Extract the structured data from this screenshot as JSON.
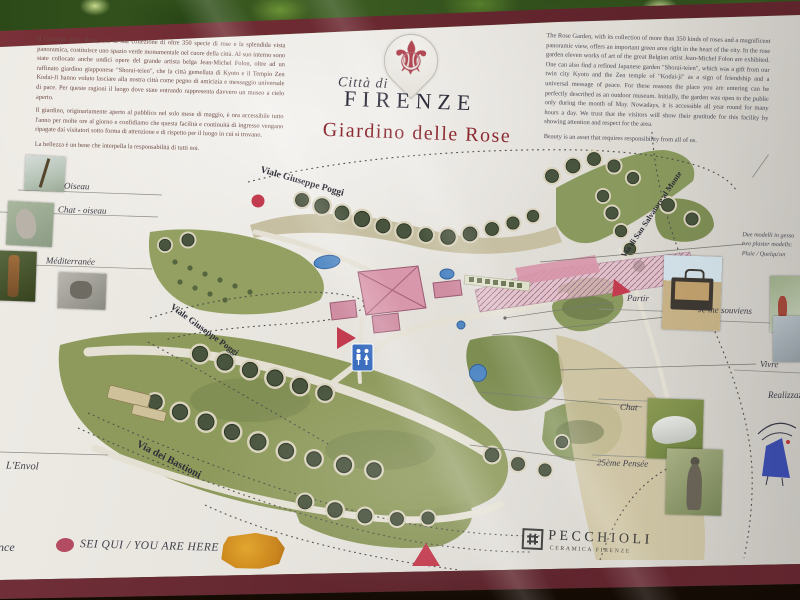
{
  "icons": {
    "fleur_de_lis": "⚜"
  },
  "header": {
    "city_script": "Città di",
    "city_name": "FIRENZE",
    "title": "Giardino delle Rose"
  },
  "intro_it": {
    "p1": "Il Giardino delle Rose, con la sua collezione di oltre 350 specie di rose e la splendida vista panoramica, costituisce uno spazio verde monumentale nel cuore della città. Al suo interno sono state collocate anche undici opere del grande artista belga Jean-Michel Folon, oltre ad un raffinato giardino giapponese \"Shorai-teien\", che la città gemellata di Kyoto e il Tempio Zen Kodai-Ji hanno voluto lasciare alla nostra città come pegno di amicizia e messaggio universale di pace. Per queste ragioni il luogo dove state entrando rappresenta davvero un museo a cielo aperto.",
    "p2": "Il giardino, originariamente aperto al pubblico nel solo mese di maggio, è ora accessibile tutto l'anno per molte ore al giorno e confidiamo che questa facilità e continuità di ingresso vengano ripagate dai visitatori sotto forma di attenzione e di rispetto per il luogo in cui si trovano.",
    "closing": "La bellezza è un bene che interpella la responsabilità di tutti noi."
  },
  "intro_en": {
    "p1": "The Rose Garden, with its collection of more than 350 kinds of roses and a magnificent panoramic view, offers an important green area right in the heart of the city. In the rose garden eleven works of art of the great Belgian artist Jean-Michel Folon are exhibited. One can also find a refined Japanese garden \"Shorai-teien\", which was a gift from our twin city Kyoto and the Zen temple of \"Kodai-ji\" as a sign of friendship and a universal message of peace. For these reasons the place you are entering can be perfectly described as an outdoor museum. Initially, the garden was open to the public only during the month of May. Nowadays, it is accessible all year round for many hours a day. We trust that the visitors will show their gratitude for this facility by showing attention and respect for the area.",
    "closing": "Beauty is an asset that requires responsibility from all of us."
  },
  "artworks_left": {
    "oiseau": "Oiseau",
    "chat_oiseau": "Chat - oiseau",
    "mediterranee": "Méditerranée",
    "envol": "L'Envol",
    "partial_bottom": "nce"
  },
  "artworks_right": {
    "plaster_note_line1": "Due modelli in gesso",
    "plaster_note_line2": "two plaster modells:",
    "plaster_note_line3": "Pluie / Quelqu'un",
    "partir": "Partir",
    "je_me_souviens": "Je me souviens",
    "vivre": "Vivre",
    "realizzaz_partial": "Realizzaz",
    "chat": "Chat",
    "pensee": "25ème Pensée"
  },
  "map": {
    "roads": {
      "viale_poggi_top": "Viale Giuseppe Poggi",
      "viale_poggi_mid": "Viale Giuseppe Poggi",
      "via_bastioni": "Via dei Bastioni",
      "via_san_salvatore": "Via di San Salvatore al Monte"
    }
  },
  "footer": {
    "you_are_here": "SEI QUI / YOU ARE HERE",
    "brand": "PECCHIOLI",
    "brand_sub": "CERAMICA FIRENZE"
  },
  "colors": {
    "frame_maroon": "#6b2a32",
    "title_red": "#8c2a32",
    "logo_red": "#b24854",
    "marker_red": "#c23b4e",
    "lawn_green": "#8e9a5c",
    "pond_blue": "#5188c4",
    "wc_blue": "#3d6fc0",
    "orange_blob": "#c9831b"
  }
}
